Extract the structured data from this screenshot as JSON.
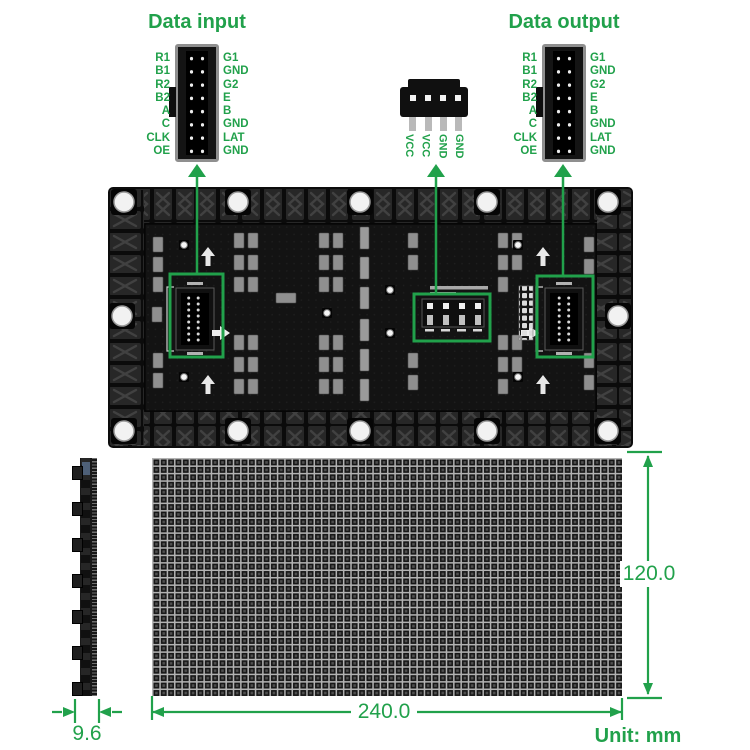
{
  "colors": {
    "accent_green": "#21A14B"
  },
  "header": {
    "input_title": "Data input",
    "output_title": "Data output"
  },
  "input_connector": {
    "left_pins": [
      "R1",
      "B1",
      "R2",
      "B2",
      "A",
      "C",
      "CLK",
      "OE"
    ],
    "right_pins": [
      "G1",
      "GND",
      "G2",
      "E",
      "B",
      "GND",
      "LAT",
      "GND"
    ]
  },
  "output_connector": {
    "left_pins": [
      "R1",
      "B1",
      "R2",
      "B2",
      "A",
      "C",
      "CLK",
      "OE"
    ],
    "right_pins": [
      "G1",
      "GND",
      "G2",
      "E",
      "B",
      "GND",
      "LAT",
      "GND"
    ]
  },
  "power_connector": {
    "pins": [
      "VCC",
      "VCC",
      "GND",
      "GND"
    ]
  },
  "dimensions": {
    "width_mm": "240.0",
    "height_mm": "120.0",
    "thickness_mm": "9.6",
    "unit_label": "Unit: mm"
  }
}
